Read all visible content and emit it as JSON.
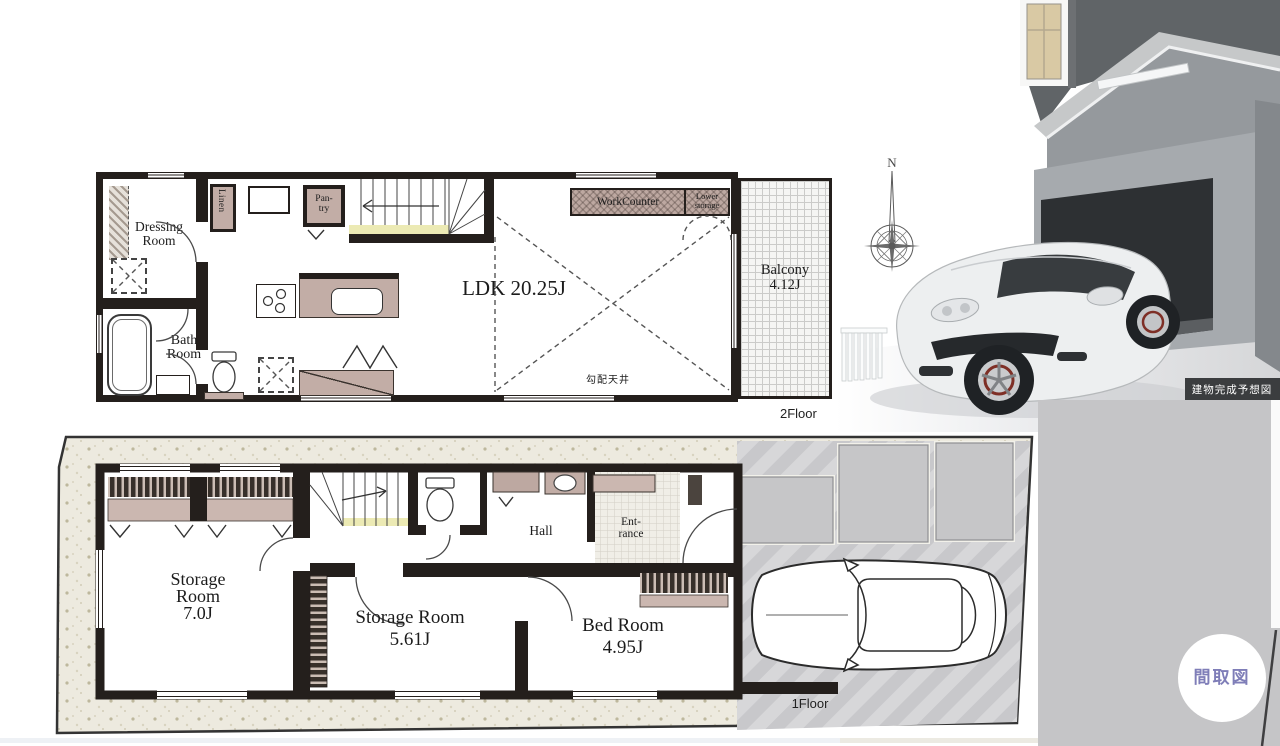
{
  "plan_2f": {
    "floor_label": "2Floor",
    "ldk_label": "LDK 20.25J",
    "balcony_line1": "Balcony",
    "balcony_line2": "4.12J",
    "dressing_line1": "Dressing",
    "dressing_line2": "Room",
    "bath_line1": "Bath",
    "bath_line2": "Room",
    "linen_label": "Linen",
    "pantry_line1": "Pan-",
    "pantry_line2": "try",
    "work_counter_label": "WorkCounter",
    "lower_storage_line1": "Lower",
    "lower_storage_line2": "storage",
    "sloped_ceiling_label": "勾配天井"
  },
  "plan_1f": {
    "floor_label": "1Floor",
    "storage7_line1": "Storage",
    "storage7_line2": "Room",
    "storage7_line3": "7.0J",
    "storage561_line1": "Storage Room",
    "storage561_line2": "5.61J",
    "bedroom_line1": "Bed Room",
    "bedroom_line2": "4.95J",
    "hall_label": "Hall",
    "entrance_line1": "Ent-",
    "entrance_line2": "rance"
  },
  "compass": {
    "north_label": "N"
  },
  "render": {
    "caption": "建物完成予想図"
  },
  "badge": {
    "label": "間取図"
  },
  "colors": {
    "wall": "#241f1c",
    "accent_mauve": "#c2ada6",
    "badge_text": "#7f7eb8",
    "panel_gray": "#c5c5c7"
  }
}
